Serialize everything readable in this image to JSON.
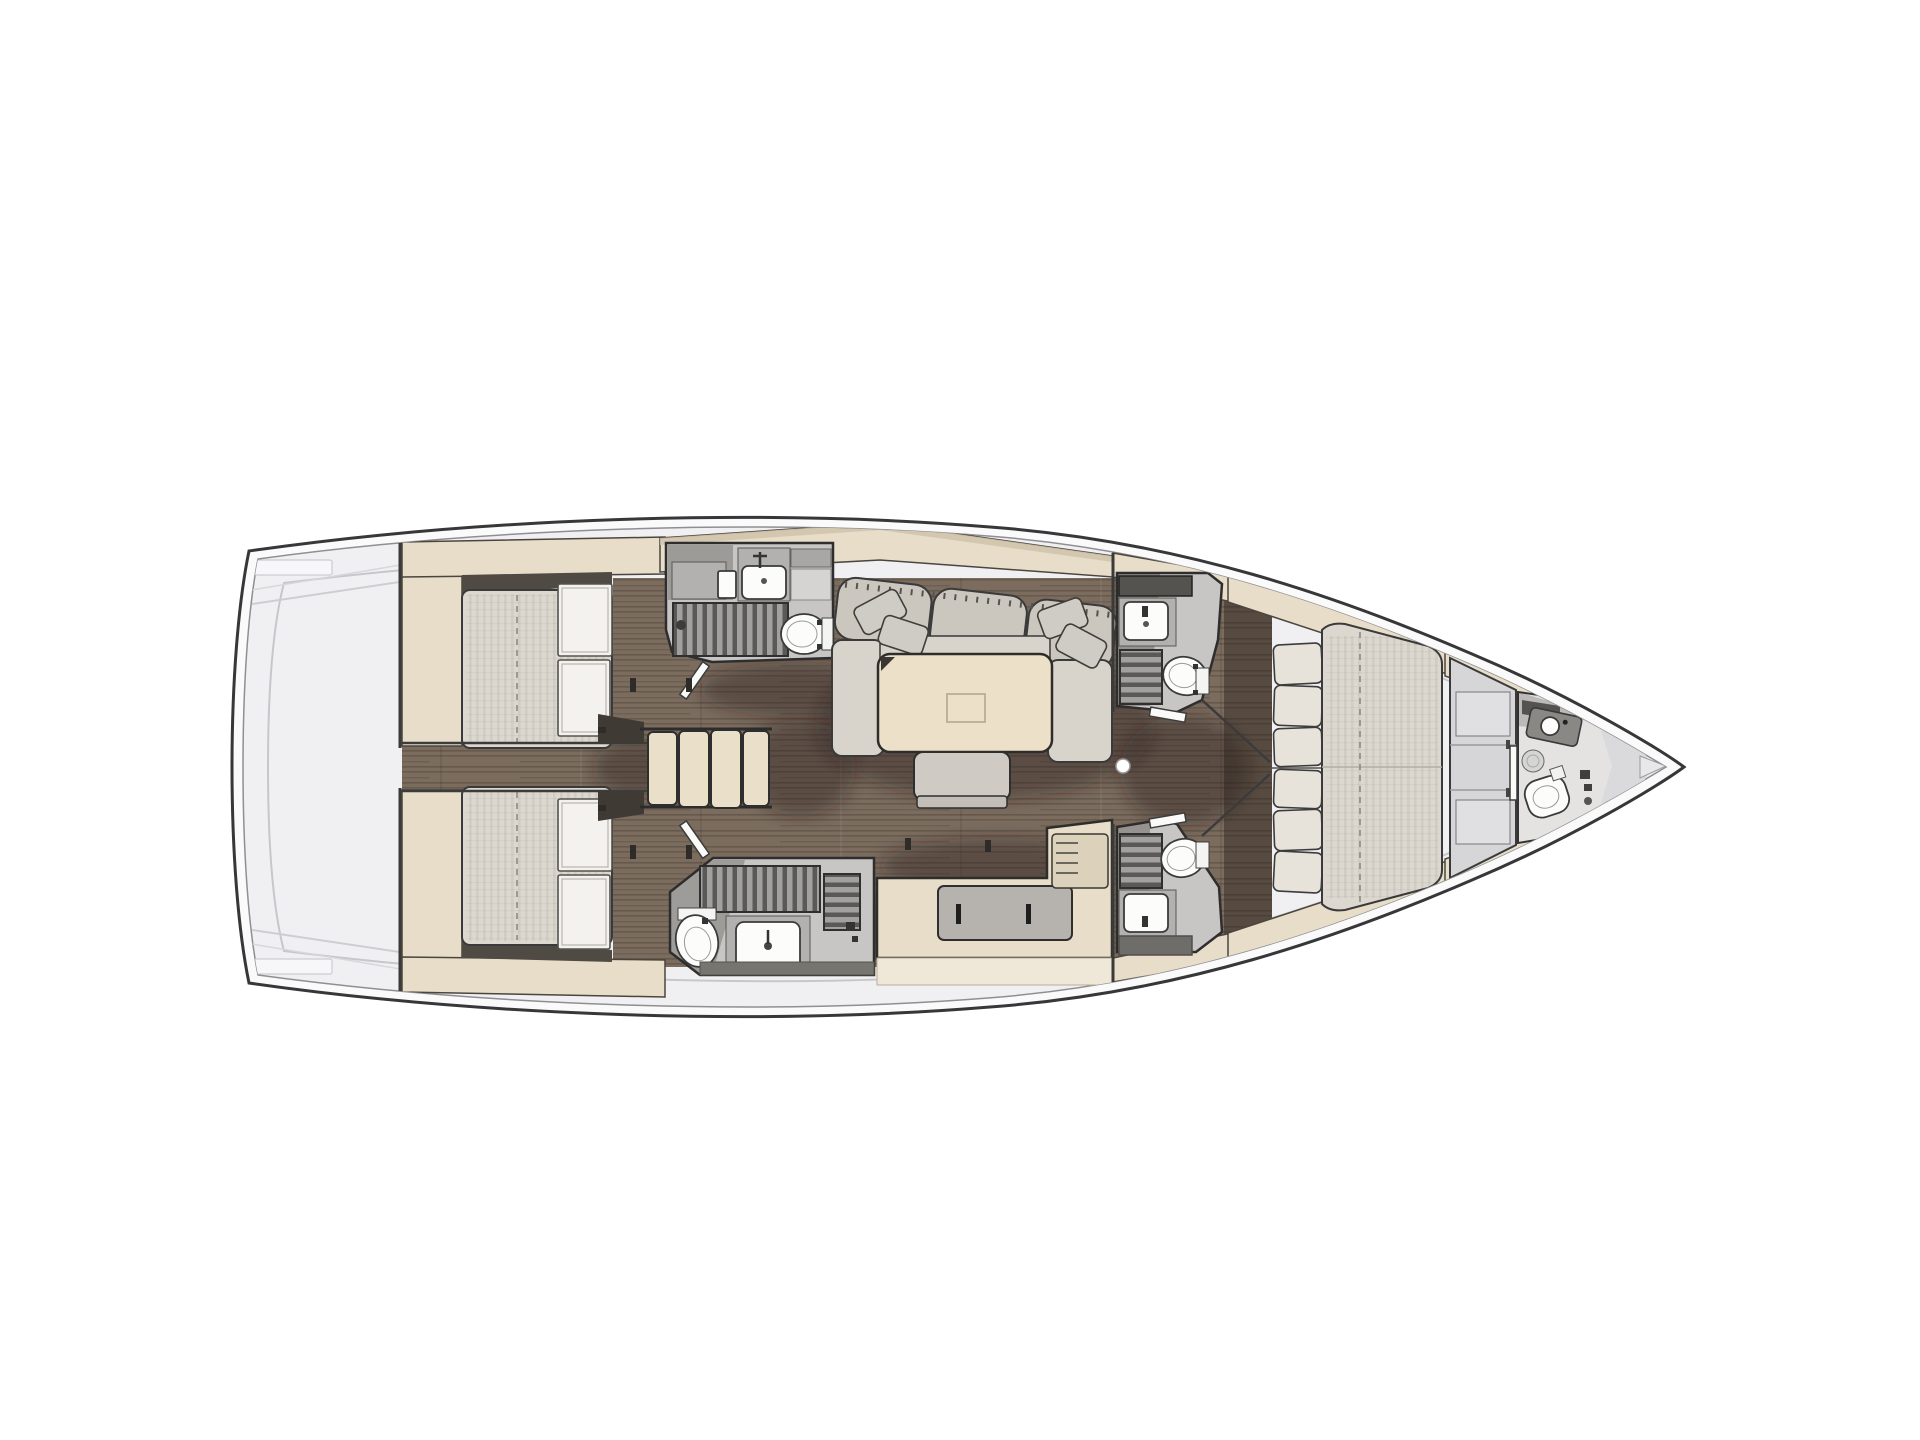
{
  "meta": {
    "type": "yacht-floor-plan",
    "view": "top-down interior layout",
    "orientation": "bow-right, stern-left",
    "visible_text": []
  },
  "palette": {
    "bg": "#ffffff",
    "hull_band": "#fafafb",
    "deck": "#f0f0f2",
    "line_dark": "#333333",
    "line_mid": "#8f8f93",
    "line_faint": "#c7c7cb",
    "wood": "#7b6c5e",
    "beige": "#e7ddc8",
    "beige_dark": "#cfc3ab",
    "beige_pale": "#efe7d7",
    "mattress": "#dcd8cf",
    "locker": "#f3f2ef",
    "sofa_seat": "#d8d4cc",
    "sofa_back": "#cbc7bf",
    "pillow": "#cfccc6",
    "table": "#ece0c8",
    "bench": "#cfcbc4",
    "head_floor": "#c8c6c4",
    "head_panel": "#b3b1af",
    "head_dark": "#55534f",
    "grate_base": "#a3a19f",
    "grate_slat": "#5a5957",
    "white_fix": "#fcfcfb",
    "galley_inset": "#b6b2ad",
    "wardrobe": "#d6d6d8",
    "bow_fill": "#e4e3e2"
  },
  "layout": {
    "stern_deck": "empty aft deck inside transom",
    "aft_cabins": [
      "aft cabin port (double berth, lockers)",
      "aft cabin starboard (double berth, lockers)"
    ],
    "corridor": "centre corridor between aft cabins",
    "companionway": "4-tread companionway steps",
    "heads_aft": [
      "port aft head: sink, shower grate, toilet",
      "starboard aft head: shower grate, toilet, sink"
    ],
    "salon": [
      "U-shaped settee with 4 throw pillows",
      "saloon table with inlay",
      "movable bench seat"
    ],
    "galley": "L-shaped galley counter with inset worktop and vent panel",
    "heads_forward": [
      "port forward head: shelf, sink, grate, toilet",
      "starboard forward head: grate, toilet, sink, shelf"
    ],
    "mast": "mast foot dot on centreline",
    "forward_cabin": "owner cabin with V double berth, headboard cushions, wardrobes",
    "bow_head": "bow washroom: counter, sink, toilet, round hatch",
    "bow": "anchor locker wedge at stem"
  }
}
